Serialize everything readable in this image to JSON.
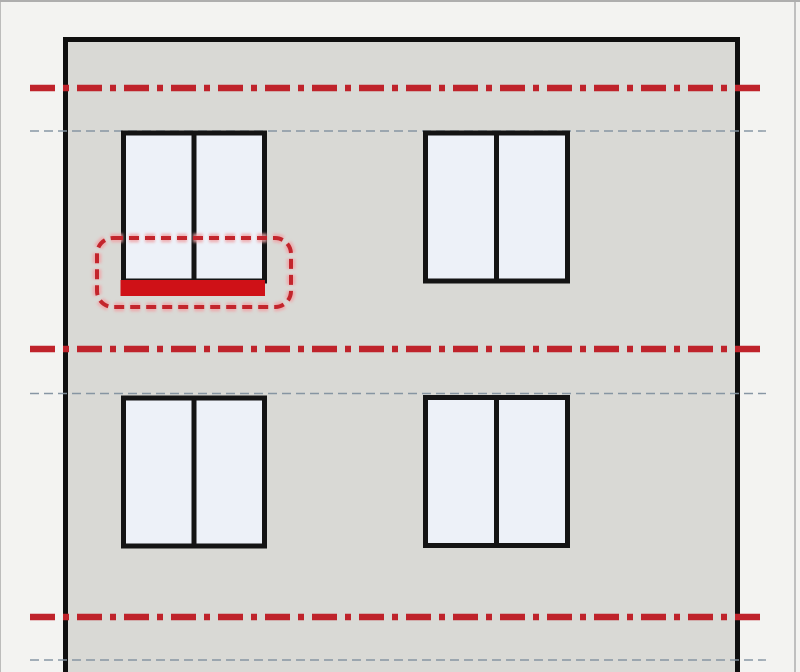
{
  "diagram": {
    "type": "building-elevation",
    "description": "Facade elevation of a two-storey building with four double-pane windows; red dash-dot level lines, thin dashed lintel lines, and a red dashed callout highlighting the sill strip of the top-left window",
    "colors": {
      "canvas_bg": "#f3f3f1",
      "frame_border": "#aeaeae",
      "wall_fill": "#d9d9d5",
      "wall_outline": "#0f0f0f",
      "window_frame": "#141414",
      "window_pane": "#edf1f8",
      "level_line": "#bf232b",
      "level_line_halo": "#f2acae",
      "lintel_line": "#8292a0",
      "sill_highlight": "#cf1117",
      "callout": "#c3252c",
      "callout_halo": "#efa5a8"
    },
    "elements": {
      "level_lines": [
        {
          "id": "level-line-top"
        },
        {
          "id": "level-line-middle"
        },
        {
          "id": "level-line-bottom"
        }
      ],
      "lintel_lines": [
        {
          "id": "lintel-line-upper"
        },
        {
          "id": "lintel-line-middle"
        },
        {
          "id": "lintel-line-lower"
        }
      ],
      "windows": [
        {
          "id": "window-top-left",
          "panes": 2
        },
        {
          "id": "window-top-right",
          "panes": 2
        },
        {
          "id": "window-bottom-left",
          "panes": 2
        },
        {
          "id": "window-bottom-right",
          "panes": 2
        }
      ],
      "highlight": {
        "id": "sill-callout",
        "target": "window-top-left-sill"
      }
    }
  }
}
